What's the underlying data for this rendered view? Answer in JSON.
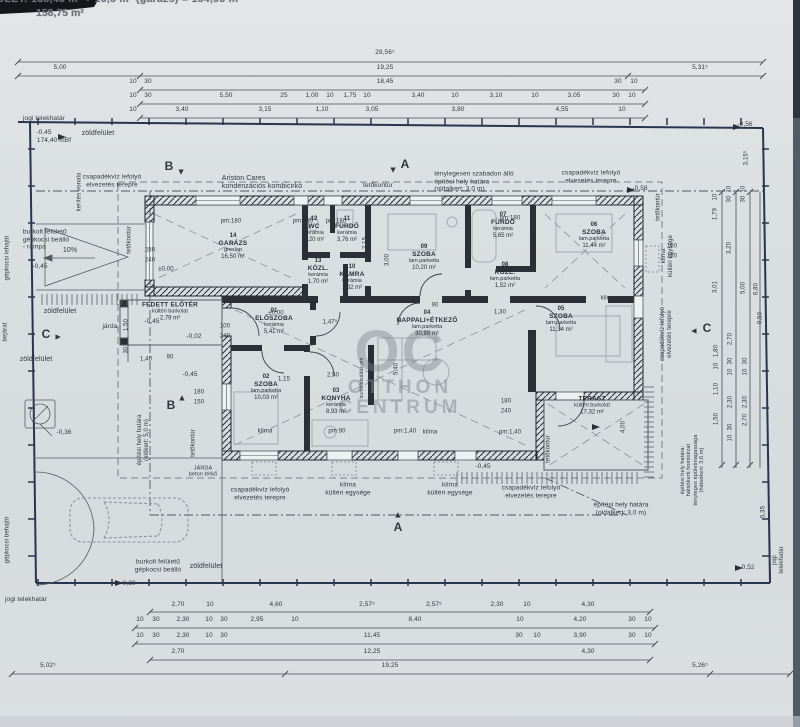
{
  "header": {
    "line1": "ÉPÜLET:  138,45 m² + 16,5 m²  (garázs)  =  154,95 m²",
    "line2": "158,75 m²"
  },
  "watermark": {
    "initials": "OC",
    "line1": "OTTHON",
    "line2": "CENTRUM"
  },
  "colors": {
    "paper": "#dadfe1",
    "wall": "#2c3036",
    "boundary": "#2a3450",
    "dash": "#7a8086",
    "accent_text": "#33373c"
  },
  "plan": {
    "rooms": [
      {
        "num": "14",
        "name": "GARÁZS",
        "floor": "greslap",
        "area": "16,50 m²",
        "x": 233,
        "y": 247
      },
      {
        "num": "12",
        "name": "WC",
        "floor": "kerámia",
        "area": "1,20 m²",
        "x": 314,
        "y": 230
      },
      {
        "num": "11",
        "name": "FÜRDŐ",
        "floor": "kerámia",
        "area": "3,76 m²",
        "x": 347,
        "y": 230
      },
      {
        "num": "13",
        "name": "KÖZL.",
        "floor": "kerámia",
        "area": "1,70 m²",
        "x": 318,
        "y": 272
      },
      {
        "num": "10",
        "name": "KAMRA",
        "floor": "kerámia",
        "area": "1,32 m²",
        "x": 352,
        "y": 278
      },
      {
        "num": "09",
        "name": "SZOBA",
        "floor": "lam.parketta",
        "area": "10,20 m²",
        "x": 424,
        "y": 258
      },
      {
        "num": "07",
        "name": "FÜRDŐ",
        "floor": "kerámia",
        "area": "5,65 m²",
        "x": 503,
        "y": 226
      },
      {
        "num": "06",
        "name": "SZOBA",
        "floor": "lam.parketta",
        "area": "11,44 m²",
        "x": 594,
        "y": 236
      },
      {
        "num": "08",
        "name": "KÖZL.",
        "floor": "lam.parketta",
        "area": "1,52 m²",
        "x": 505,
        "y": 276
      },
      {
        "num": "01",
        "name": "ELŐSZOBA",
        "floor": "kerámia",
        "area": "5,41 m²",
        "x": 274,
        "y": 322
      },
      {
        "num": "02",
        "name": "SZOBA",
        "floor": "lam.parketta",
        "area": "10,03 m²",
        "x": 266,
        "y": 388
      },
      {
        "num": "03",
        "name": "KONYHA",
        "floor": "kerámia",
        "area": "8,93 m²",
        "x": 336,
        "y": 402
      },
      {
        "num": "04",
        "name": "NAPPALI+ÉTKEZŐ",
        "floor": "lam.parketta",
        "area": "30,88 m²",
        "x": 427,
        "y": 324
      },
      {
        "num": "05",
        "name": "SZOBA",
        "floor": "lam.parketta",
        "area": "11,34 m²",
        "x": 561,
        "y": 320
      },
      {
        "num": "",
        "name": "TERASZ",
        "floor": "kültéri burkolat",
        "area": "17,32 m²",
        "x": 592,
        "y": 406
      },
      {
        "num": "",
        "name": "FEDETT ELŐTÉR",
        "floor": "kültéri burkolat",
        "area": "2,79 m²",
        "x": 170,
        "y": 312
      }
    ],
    "annotations": [
      {
        "t": "jogi telekhatár",
        "x": 44,
        "y": 119,
        "fs": 6.5
      },
      {
        "t": "-0,45",
        "x": 44,
        "y": 133,
        "fs": 6.5
      },
      {
        "t": "174,40 mBf",
        "x": 54,
        "y": 141,
        "fs": 6.5
      },
      {
        "t": "zöldfelület",
        "x": 98,
        "y": 134,
        "fs": 7
      },
      {
        "t": "csapadékvíz lefolyó\nelvezetés terepre",
        "x": 112,
        "y": 181,
        "fs": 6.5
      },
      {
        "t": "Ariston Cares\nkondenzációs kombicirkó",
        "x": 262,
        "y": 183,
        "fs": 7,
        "al": "left"
      },
      {
        "t": "tetőkontúr",
        "x": 378,
        "y": 186,
        "fs": 6.5
      },
      {
        "t": "ténylegesen szabadon álló\népítési hely határa\n(oldalkert: 3,0 m)",
        "x": 474,
        "y": 182,
        "fs": 6.5,
        "al": "left"
      },
      {
        "t": "csapadékvíz lefolyó\nelvezetés terepre",
        "x": 591,
        "y": 177,
        "fs": 6.5
      },
      {
        "t": "-0,58",
        "x": 640,
        "y": 189,
        "fs": 6.5
      },
      {
        "t": "-0,56",
        "x": 745,
        "y": 125,
        "fs": 6.5
      },
      {
        "t": "kerítés vonala",
        "x": 80,
        "y": 192,
        "fs": 6,
        "r": -90
      },
      {
        "t": "tetőkontúr",
        "x": 130,
        "y": 240,
        "fs": 6,
        "r": -90
      },
      {
        "t": "tetőkontúr",
        "x": 659,
        "y": 207,
        "fs": 6,
        "r": -90
      },
      {
        "t": "burkolt felületű\ngépkocsi beálló\n- rámpa",
        "x": 46,
        "y": 240,
        "fs": 6.5,
        "al": "left"
      },
      {
        "t": "10%",
        "x": 70,
        "y": 251,
        "fs": 7
      },
      {
        "t": "-0,45",
        "x": 40,
        "y": 267,
        "fs": 6.5
      },
      {
        "t": "gépkocsi lehajtó",
        "x": 8,
        "y": 258,
        "fs": 6,
        "r": -90
      },
      {
        "t": "zöldfelület",
        "x": 60,
        "y": 312,
        "fs": 7
      },
      {
        "t": "járda",
        "x": 110,
        "y": 327,
        "fs": 6.5
      },
      {
        "t": "zöldfelület",
        "x": 36,
        "y": 360,
        "fs": 7
      },
      {
        "t": "bejárat",
        "x": 6,
        "y": 332,
        "fs": 6,
        "r": -90
      },
      {
        "t": "-0,36",
        "x": 64,
        "y": 433,
        "fs": 6.5
      },
      {
        "t": "építési hely határa\n(előkert: 5,0 m)",
        "x": 144,
        "y": 440,
        "fs": 6,
        "r": -90
      },
      {
        "t": "-0,45",
        "x": 152,
        "y": 322,
        "fs": 6.5
      },
      {
        "t": "-0,02",
        "x": 194,
        "y": 337,
        "fs": 6.5
      },
      {
        "t": "-0,45",
        "x": 190,
        "y": 375,
        "fs": 6.5
      },
      {
        "t": "JÁRDA\nbeton térkő",
        "x": 203,
        "y": 472,
        "fs": 5.5
      },
      {
        "t": "csapadékvíz lefolyó\nelvezetés terepre",
        "x": 260,
        "y": 494,
        "fs": 6.5
      },
      {
        "t": "klíma\nkültéri egysége",
        "x": 348,
        "y": 489,
        "fs": 6.5
      },
      {
        "t": "klíma\nkültéri egysége",
        "x": 450,
        "y": 489,
        "fs": 6.5
      },
      {
        "t": "csapadékvíz lefolyó\nelvezetés terepre",
        "x": 531,
        "y": 492,
        "fs": 6.5
      },
      {
        "t": "-0,45",
        "x": 483,
        "y": 467,
        "fs": 6.5
      },
      {
        "t": "építési hely határa\n(oldalkert: 3,0 m)",
        "x": 621,
        "y": 509,
        "fs": 6.5
      },
      {
        "t": "építési hely határa:\nhátsókerti homlokzat\ntényleges épületmagassága\n(hátsókert: 3,6 m)",
        "x": 693,
        "y": 470,
        "fs": 5.5,
        "r": -90
      },
      {
        "t": "csapadékvíz lefolyó\nelvezetés terepre",
        "x": 667,
        "y": 334,
        "fs": 6,
        "r": -90
      },
      {
        "t": "klíma\nkültéri egysége",
        "x": 668,
        "y": 256,
        "fs": 6,
        "r": -90
      },
      {
        "t": "klíma",
        "x": 608,
        "y": 299,
        "fs": 6
      },
      {
        "t": "klíma",
        "x": 265,
        "y": 432,
        "fs": 6
      },
      {
        "t": "klíma",
        "x": 430,
        "y": 433,
        "fs": 6
      },
      {
        "t": "tetőkontúr",
        "x": 194,
        "y": 443,
        "fs": 6,
        "r": -90
      },
      {
        "t": "tetőkontúr",
        "x": 549,
        "y": 449,
        "fs": 6,
        "r": -90
      },
      {
        "t": "burkolt felületű\ngépkocsi beálló",
        "x": 158,
        "y": 566,
        "fs": 6.5
      },
      {
        "t": "zöldfelület",
        "x": 206,
        "y": 567,
        "fs": 7
      },
      {
        "t": "-0,30",
        "x": 128,
        "y": 584,
        "fs": 6.5
      },
      {
        "t": "gépkocsi behajtó",
        "x": 8,
        "y": 540,
        "fs": 6,
        "r": -90
      },
      {
        "t": "jogi telekhatár",
        "x": 26,
        "y": 600,
        "fs": 6.5
      },
      {
        "t": "jogi telekhatár",
        "x": 779,
        "y": 560,
        "fs": 6,
        "r": -90
      },
      {
        "t": "-0,52",
        "x": 747,
        "y": 568,
        "fs": 6.5
      },
      {
        "t": "burkolatváltás pm",
        "x": 363,
        "y": 378,
        "fs": 5,
        "r": -90
      },
      {
        "t": "A",
        "x": 405,
        "y": 164,
        "fs": 12,
        "b": true
      },
      {
        "t": "▲",
        "x": 393,
        "y": 170,
        "fs": 9,
        "r": 180
      },
      {
        "t": "A",
        "x": 398,
        "y": 527,
        "fs": 12,
        "b": true
      },
      {
        "t": "▲",
        "x": 398,
        "y": 515,
        "fs": 9
      },
      {
        "t": "B",
        "x": 169,
        "y": 166,
        "fs": 12,
        "b": true
      },
      {
        "t": "▲",
        "x": 181,
        "y": 172,
        "fs": 9,
        "r": 180
      },
      {
        "t": "B",
        "x": 171,
        "y": 405,
        "fs": 12,
        "b": true
      },
      {
        "t": "▲",
        "x": 182,
        "y": 398,
        "fs": 9
      },
      {
        "t": "C",
        "x": 46,
        "y": 334,
        "fs": 12,
        "b": true
      },
      {
        "t": "▲",
        "x": 58,
        "y": 337,
        "fs": 9,
        "r": 90
      },
      {
        "t": "C",
        "x": 707,
        "y": 328,
        "fs": 12,
        "b": true
      },
      {
        "t": "▲",
        "x": 694,
        "y": 331,
        "fs": 9,
        "r": -90
      }
    ],
    "dims": [
      {
        "t": "3,15⁵",
        "x": 747,
        "y": 158,
        "r": -90
      },
      {
        "t": "9,50",
        "x": 761,
        "y": 318,
        "r": -90
      },
      {
        "t": "5,35",
        "x": 764,
        "y": 512,
        "r": -90
      },
      {
        "t": "1,79",
        "x": 716,
        "y": 214,
        "r": -90
      },
      {
        "t": "10",
        "x": 716,
        "y": 197,
        "r": -90
      },
      {
        "t": "30",
        "x": 730,
        "y": 199,
        "r": -90
      },
      {
        "t": "10",
        "x": 730,
        "y": 189,
        "r": -90
      },
      {
        "t": "3,20",
        "x": 730,
        "y": 248,
        "r": -90
      },
      {
        "t": "30",
        "x": 744,
        "y": 199,
        "r": -90
      },
      {
        "t": "10",
        "x": 744,
        "y": 189,
        "r": -90
      },
      {
        "t": "3,01",
        "x": 716,
        "y": 287,
        "r": -90
      },
      {
        "t": "5,00",
        "x": 744,
        "y": 288,
        "r": -90
      },
      {
        "t": "6,80",
        "x": 757,
        "y": 289,
        "r": -90
      },
      {
        "t": "1,80",
        "x": 717,
        "y": 351,
        "r": -90
      },
      {
        "t": "10",
        "x": 717,
        "y": 366,
        "r": -90
      },
      {
        "t": "1,10",
        "x": 717,
        "y": 389,
        "r": -90
      },
      {
        "t": "1,50",
        "x": 717,
        "y": 419,
        "r": -90
      },
      {
        "t": "2,70",
        "x": 731,
        "y": 339,
        "r": -90
      },
      {
        "t": "30",
        "x": 731,
        "y": 361,
        "r": -90
      },
      {
        "t": "10",
        "x": 731,
        "y": 372,
        "r": -90
      },
      {
        "t": "2,30",
        "x": 731,
        "y": 402,
        "r": -90
      },
      {
        "t": "30",
        "x": 731,
        "y": 427,
        "r": -90
      },
      {
        "t": "10",
        "x": 731,
        "y": 438,
        "r": -90
      },
      {
        "t": "2,70",
        "x": 746,
        "y": 420,
        "r": -90
      },
      {
        "t": "30",
        "x": 746,
        "y": 361,
        "r": -90
      },
      {
        "t": "10",
        "x": 746,
        "y": 372,
        "r": -90
      },
      {
        "t": "2,30",
        "x": 746,
        "y": 402,
        "r": -90
      },
      {
        "t": "4,00",
        "x": 624,
        "y": 427,
        "r": -90
      },
      {
        "t": "5,40",
        "x": 397,
        "y": 369,
        "r": -90
      },
      {
        "t": "3,00",
        "x": 388,
        "y": 260,
        "r": -90
      },
      {
        "t": "2,15",
        "x": 366,
        "y": 243,
        "r": -90
      },
      {
        "t": "1,50",
        "x": 127,
        "y": 325,
        "r": -90
      },
      {
        "t": "30",
        "x": 127,
        "y": 350,
        "r": -90
      },
      {
        "t": "280",
        "x": 150,
        "y": 251
      },
      {
        "t": "240",
        "x": 150,
        "y": 261
      },
      {
        "t": "±0,00",
        "x": 166,
        "y": 270
      },
      {
        "t": "±0,00",
        "x": 276,
        "y": 314
      },
      {
        "t": "pm:180",
        "x": 231,
        "y": 222
      },
      {
        "t": "pm:180",
        "x": 303,
        "y": 222
      },
      {
        "t": "pm:180",
        "x": 336,
        "y": 222
      },
      {
        "t": "pm:180",
        "x": 510,
        "y": 219
      },
      {
        "t": "pm:90",
        "x": 337,
        "y": 432
      },
      {
        "t": "pm:1,40",
        "x": 405,
        "y": 432
      },
      {
        "t": "pm:1,40",
        "x": 510,
        "y": 433
      },
      {
        "t": "180",
        "x": 672,
        "y": 247
      },
      {
        "t": "150",
        "x": 672,
        "y": 257
      },
      {
        "t": "180",
        "x": 199,
        "y": 393
      },
      {
        "t": "150",
        "x": 199,
        "y": 403
      },
      {
        "t": "100",
        "x": 225,
        "y": 327
      },
      {
        "t": "240",
        "x": 225,
        "y": 337
      },
      {
        "t": "180",
        "x": 506,
        "y": 402
      },
      {
        "t": "240",
        "x": 506,
        "y": 412
      },
      {
        "t": "2,50",
        "x": 333,
        "y": 376
      },
      {
        "t": "1,15",
        "x": 284,
        "y": 380
      },
      {
        "t": "1,47⁵",
        "x": 330,
        "y": 323
      },
      {
        "t": "1,30",
        "x": 500,
        "y": 313
      },
      {
        "t": "90",
        "x": 435,
        "y": 306
      },
      {
        "t": "1,40",
        "x": 146,
        "y": 360
      },
      {
        "t": "90",
        "x": 170,
        "y": 358
      }
    ],
    "dim_rows": [
      {
        "y": 53,
        "items": [
          [
            "29,56⁵",
            385
          ]
        ]
      },
      {
        "y": 68,
        "items": [
          [
            "5,00",
            60
          ],
          [
            "19,25",
            385
          ],
          [
            "5,31⁵",
            700
          ]
        ]
      },
      {
        "y": 82,
        "items": [
          [
            "10",
            133
          ],
          [
            "30",
            148
          ],
          [
            "18,45",
            385
          ],
          [
            "30",
            618
          ],
          [
            "10",
            634
          ]
        ]
      },
      {
        "y": 96,
        "items": [
          [
            "10",
            133
          ],
          [
            "30",
            148
          ],
          [
            "5,50",
            226
          ],
          [
            "25",
            284
          ],
          [
            "1,00",
            312
          ],
          [
            "10",
            330
          ],
          [
            "1,75",
            350
          ],
          [
            "10",
            367
          ],
          [
            "3,40",
            418
          ],
          [
            "10",
            455
          ],
          [
            "3,10",
            496
          ],
          [
            "10",
            535
          ],
          [
            "3,05",
            574
          ],
          [
            "30",
            616
          ],
          [
            "10",
            632
          ]
        ]
      },
      {
        "y": 110,
        "items": [
          [
            "10",
            133
          ],
          [
            "3,40",
            182
          ],
          [
            "3,15",
            265
          ],
          [
            "1,10",
            322
          ],
          [
            "3,05",
            372
          ],
          [
            "3,80",
            458
          ],
          [
            "4,55",
            562
          ],
          [
            "10",
            622
          ]
        ]
      },
      {
        "y": 605,
        "items": [
          [
            "2,70",
            178
          ],
          [
            "10",
            210
          ],
          [
            "4,60",
            276
          ],
          [
            "2,57⁵",
            367
          ],
          [
            "2,57⁵",
            434
          ],
          [
            "2,30",
            497
          ],
          [
            "10",
            527
          ],
          [
            "4,30",
            588
          ]
        ]
      },
      {
        "y": 620,
        "items": [
          [
            "10",
            140
          ],
          [
            "30",
            156
          ],
          [
            "2,30",
            183
          ],
          [
            "10",
            209
          ],
          [
            "30",
            224
          ],
          [
            "2,95",
            257
          ],
          [
            "10",
            295
          ],
          [
            "8,40",
            415
          ],
          [
            "10",
            520
          ],
          [
            "4,20",
            580
          ],
          [
            "30",
            632
          ],
          [
            "10",
            648
          ]
        ]
      },
      {
        "y": 636,
        "items": [
          [
            "10",
            140
          ],
          [
            "30",
            156
          ],
          [
            "2,30",
            183
          ],
          [
            "10",
            209
          ],
          [
            "30",
            224
          ],
          [
            "11,45",
            372
          ],
          [
            "30",
            519
          ],
          [
            "10",
            537
          ],
          [
            "3,90",
            580
          ],
          [
            "30",
            632
          ],
          [
            "10",
            648
          ]
        ]
      },
      {
        "y": 652,
        "items": [
          [
            "2,70",
            178
          ],
          [
            "12,25",
            372
          ],
          [
            "4,30",
            588
          ]
        ]
      },
      {
        "y": 666,
        "items": [
          [
            "5,02⁵",
            48
          ],
          [
            "19,25",
            390
          ],
          [
            "5,26⁵",
            700
          ]
        ]
      }
    ]
  }
}
